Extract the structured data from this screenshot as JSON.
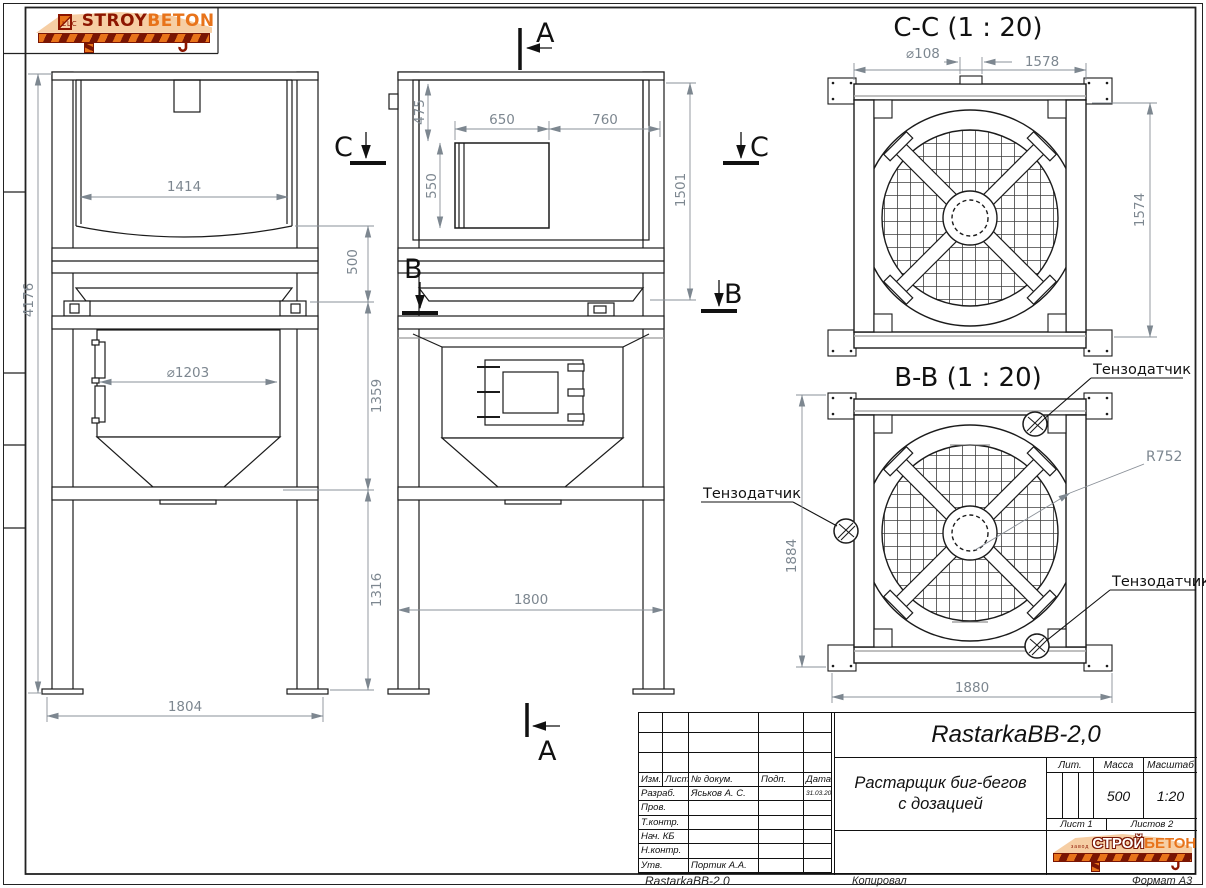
{
  "brand": {
    "top": {
      "llc": "LLC",
      "stroy": "STROY",
      "beton": "BETON"
    },
    "block": {
      "zavod": "завод",
      "stroy": "СТРОЙ",
      "beton": "БЕТОН"
    },
    "colors": {
      "orange": "#E8731A",
      "dark_red": "#8C1500",
      "peach": "#F6CEA4"
    }
  },
  "views": {
    "side": {
      "dim_height": "4176",
      "dim_top_width": "1414",
      "dim_gap": "500",
      "dim_cylinder": "⌀1203",
      "dim_hopper": "1359",
      "dim_under": "1316",
      "dim_base": "1804"
    },
    "front": {
      "dim_top": "475",
      "dim_door_w": "650",
      "dim_door_r": "760",
      "dim_door_h": "550",
      "dim_box_h": "1501",
      "dim_base": "1800"
    },
    "cc": {
      "title": "C-C  (1 : 20)",
      "dim_spout": "⌀108",
      "dim_beam": "1578",
      "dim_height": "1574"
    },
    "bb": {
      "title": "B-B  (1 : 20)",
      "dim_height": "1884",
      "dim_width": "1880",
      "dim_radius": "R752",
      "load_cell": "Тензодатчик"
    }
  },
  "markers": {
    "a": "A",
    "b": "B",
    "c": "C"
  },
  "tb": {
    "designation": "RastarkaBB-2,0",
    "doc_name_line1": "Растарщик биг-бегов",
    "doc_name_line2": "с дозацией",
    "header": {
      "izm": "Изм.",
      "list": "Лист",
      "ndoc": "№ докум.",
      "podp": "Подп.",
      "data": "Дата"
    },
    "rows": [
      {
        "role": "Разраб.",
        "name": "Яськов А. С.",
        "date": "31.03.2014"
      },
      {
        "role": "Пров.",
        "name": "",
        "date": ""
      },
      {
        "role": "Т.контр.",
        "name": "",
        "date": ""
      },
      {
        "role": "Нач. КБ",
        "name": "",
        "date": ""
      },
      {
        "role": "Н.контр.",
        "name": "",
        "date": ""
      },
      {
        "role": "Утв.",
        "name": "Портик А.А.",
        "date": ""
      }
    ],
    "lit_label": "Лит.",
    "mass_label": "Масса",
    "scale_label": "Масштаб",
    "mass_value": "500",
    "scale_value": "1:20",
    "sheet_label": "Лист 1",
    "sheets_label": "Листов 2"
  },
  "footer": {
    "doc": "RastarkaBB-2.0",
    "copied": "Копировал",
    "format": "Формат А3"
  }
}
